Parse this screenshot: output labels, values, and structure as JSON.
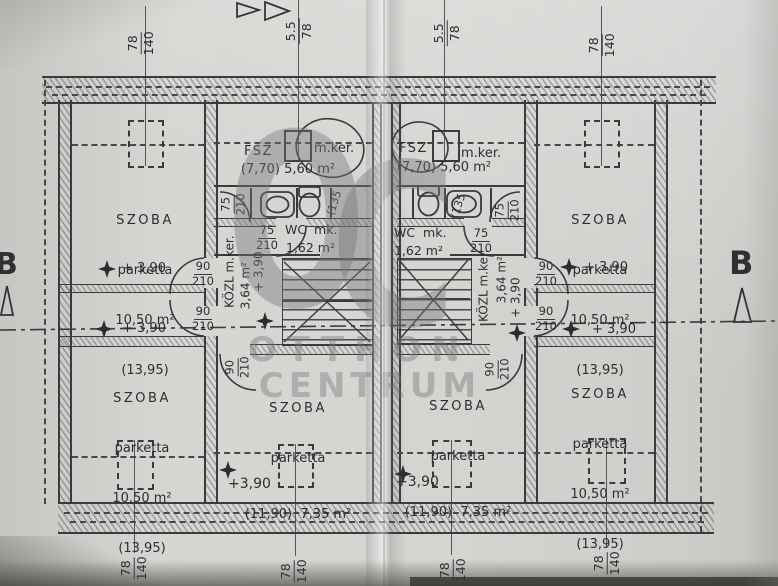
{
  "watermark": {
    "logo_o": "O",
    "logo_c": "C",
    "line1": "OTTHON",
    "line2": "CENTRUM"
  },
  "section": {
    "b_left": "B",
    "b_right": "B"
  },
  "dims": {
    "roof_big_w": "78",
    "roof_big_h": "140",
    "roof_small_w": "5.5",
    "roof_small_h": "78"
  },
  "doors": {
    "w90": "90",
    "w75": "75",
    "h210": "210"
  },
  "rooms": {
    "szoba_big": {
      "name": "SZOBA",
      "floor": "parketta",
      "area": "10,50 m²",
      "alt": "(13,95)"
    },
    "szoba_small": {
      "name": "SZOBA",
      "floor": "parketta",
      "area": "(11,90)  7,35 m²"
    },
    "fsz": {
      "name": "FSZ",
      "annex": "m.ker.",
      "area": "(7,70) 5,60 m²"
    },
    "wc": {
      "name": "WC  mk.",
      "area": "1,62 m²"
    },
    "hall": {
      "name": "KÖZL m.ker.",
      "area": "3,64 m²",
      "level": "+ 3,90"
    }
  },
  "levels": {
    "mark": "+ 3,90",
    "mark_tight": "+3,90"
  },
  "misc": {
    "sill": "(135"
  }
}
